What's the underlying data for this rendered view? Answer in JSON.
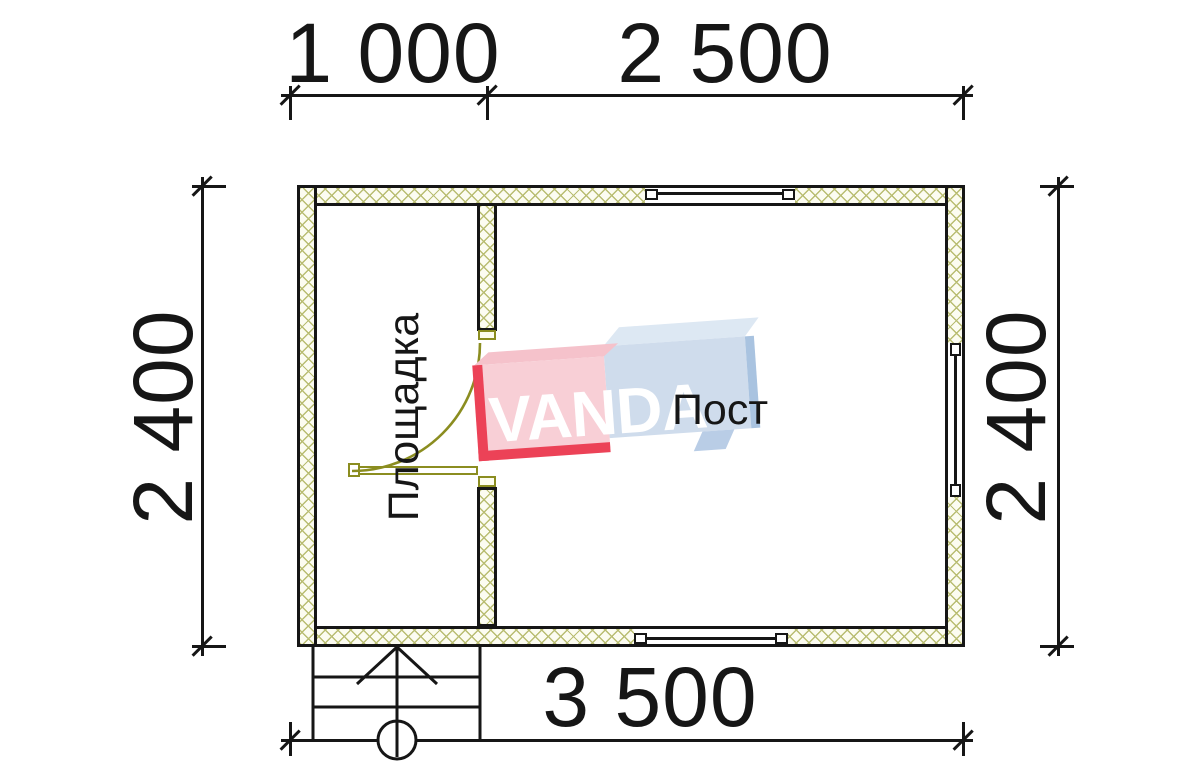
{
  "drawing": {
    "type": "floor-plan",
    "units": "mm"
  },
  "dimensions": {
    "top_segment_1": "1 000",
    "top_segment_2": "2 500",
    "bottom_total": "3 500",
    "left_height": "2 400",
    "right_height": "2 400"
  },
  "rooms": {
    "left_label": "Площадка",
    "right_label": "Пост"
  },
  "watermark": {
    "text": "VANDA",
    "red_face": "#f8cfd6",
    "red_edge": "#ec4257",
    "blue_face": "#cfdcec",
    "blue_edge": "#a9c3e0"
  },
  "colors": {
    "line": "#161616",
    "hatch": "#b9bd72",
    "door": "#8b8d20"
  }
}
